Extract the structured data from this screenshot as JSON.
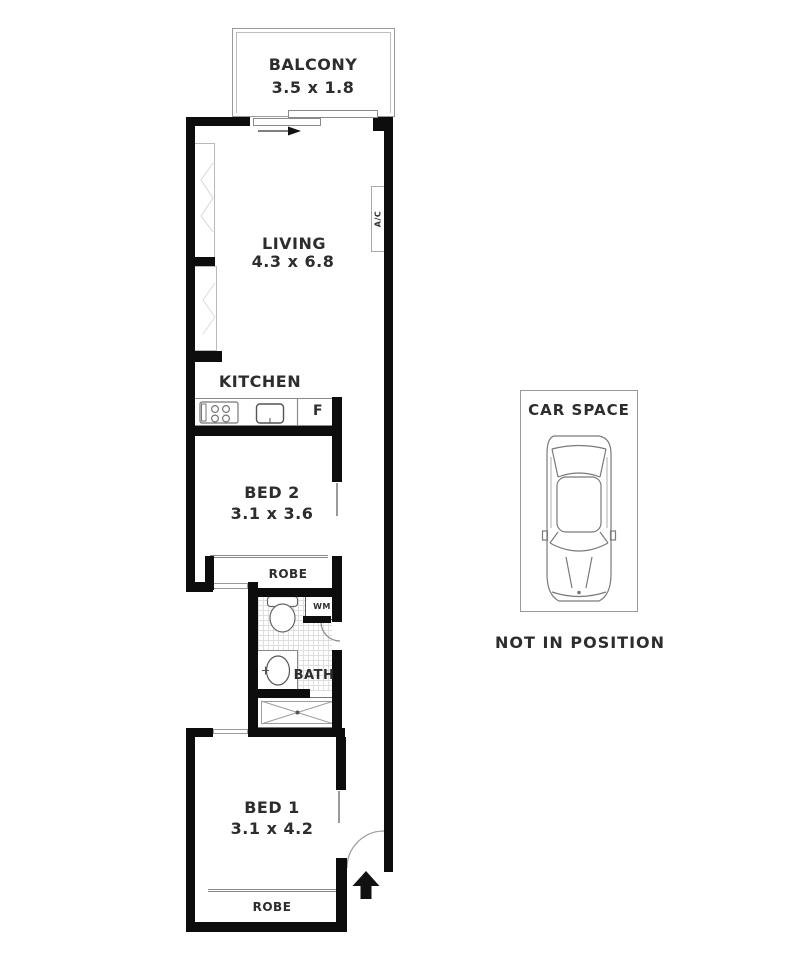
{
  "labels": {
    "balcony_name": "BALCONY",
    "balcony_dims": "3.5 x 1.8",
    "living_name": "LIVING",
    "living_dims": "4.3 x 6.8",
    "ac": "A/C",
    "kitchen_name": "KITCHEN",
    "fridge": "F",
    "bed2_name": "BED 2",
    "bed2_dims": "3.1 x 3.6",
    "robe_bed2": "ROBE",
    "wm": "WM",
    "bath": "BATH",
    "bed1_name": "BED 1",
    "bed1_dims": "3.1 x 4.2",
    "robe_bed1": "ROBE",
    "car_space_title": "CAR SPACE",
    "car_space_note": "NOT IN POSITION"
  },
  "colors": {
    "wall": "#0d0d0d",
    "outline": "#8a8a8a",
    "text": "#2d2d2d",
    "hatch": "#dedede",
    "background": "#ffffff"
  }
}
